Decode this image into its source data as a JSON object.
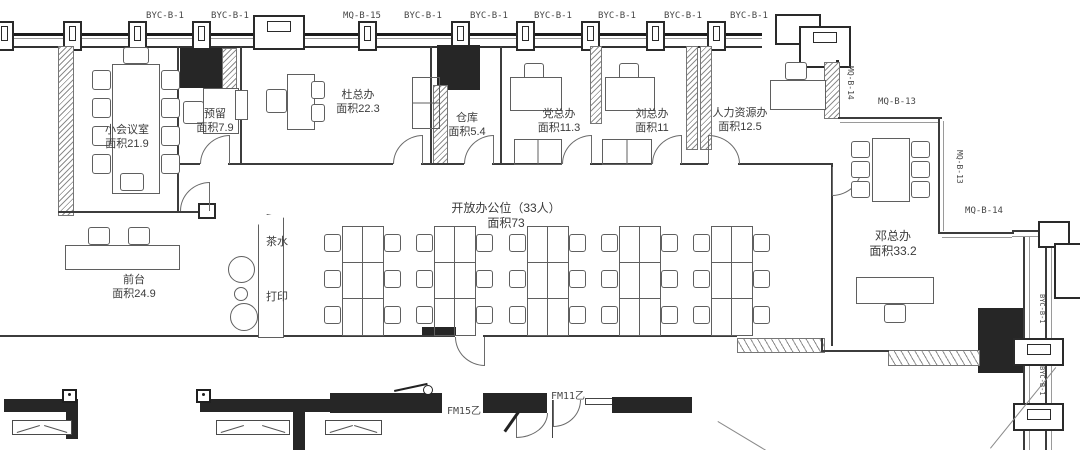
{
  "drawing": {
    "type": "office-floor-plan"
  },
  "facade": {
    "top": [
      "BYC-B-1",
      "BYC-B-1",
      "MQ-B-15",
      "BYC-B-1",
      "BYC-B-1",
      "BYC-B-1",
      "BYC-B-1",
      "BYC-B-1",
      "BYC-B-1"
    ],
    "right": [
      "MQ-B-14",
      "MQ-B-13",
      "MQ-B-13",
      "MQ-B-14",
      "BYC-B-1",
      "BYC-B-1"
    ]
  },
  "rooms": [
    {
      "name": "小会议室",
      "area": "面积21.9"
    },
    {
      "name": "预留",
      "area": "面积7.9"
    },
    {
      "name": "杜总办",
      "area": "面积22.3"
    },
    {
      "name": "仓库",
      "area": "面积5.4"
    },
    {
      "name": "党总办",
      "area": "面积11.3"
    },
    {
      "name": "刘总办",
      "area": "面积11"
    },
    {
      "name": "人力资源办",
      "area": "面积12.5"
    },
    {
      "name": "开放办公位（33人）",
      "area": "面积73"
    },
    {
      "name": "前台",
      "area": "面积24.9"
    },
    {
      "name": "邓总办",
      "area": "面积33.2"
    }
  ],
  "amenities": {
    "tea": "茶水",
    "print": "打印"
  },
  "fire_doors": [
    "FM15乙",
    "FM11乙"
  ],
  "colors": {
    "wall": "#3c3c3c",
    "column_fill": "#262626",
    "text": "#3b3b3b"
  }
}
